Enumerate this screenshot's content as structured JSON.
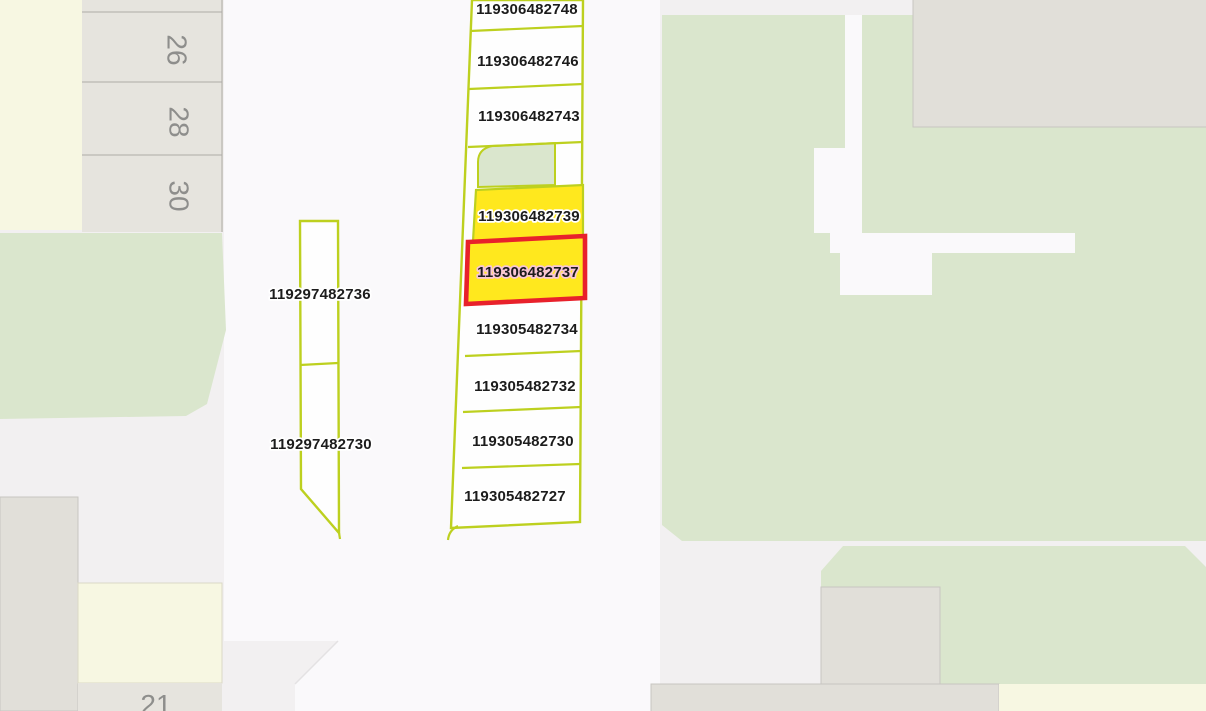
{
  "map": {
    "description": "Cadastral parcel map view",
    "center_parcels": [
      {
        "id": "119306482748",
        "state": "normal"
      },
      {
        "id": "119306482746",
        "state": "normal"
      },
      {
        "id": "119306482743",
        "state": "normal"
      },
      {
        "id": "119306482739",
        "state": "highlighted"
      },
      {
        "id": "119306482737",
        "state": "selected"
      },
      {
        "id": "119305482734",
        "state": "normal"
      },
      {
        "id": "119305482732",
        "state": "normal"
      },
      {
        "id": "119305482730",
        "state": "normal"
      },
      {
        "id": "119305482727",
        "state": "normal"
      }
    ],
    "west_parcels": [
      {
        "id": "119297482736"
      },
      {
        "id": "119297482730"
      }
    ],
    "house_numbers": [
      "26",
      "28",
      "30"
    ],
    "partial_house_number": "21",
    "colors": {
      "bg": "#f2f0f1",
      "road": "#faf9fb",
      "parcel_fill": "#fefefe",
      "pale_yellow": "#f7f7e2",
      "green": "#dae6cd",
      "building": "#e1dfd9",
      "building_stroke": "#c8c6c1",
      "strip": "#e6e4de",
      "strip_line": "#adaba7",
      "olive": "#bdd01f",
      "yellow": "#ffe81e",
      "red": "#e8212b",
      "label": "#1c1c1c",
      "halo": "#ffffff",
      "halo_selected": "#f8c6d5",
      "housenum": "#8e8e8c",
      "seam": "#e4e2e3"
    }
  }
}
